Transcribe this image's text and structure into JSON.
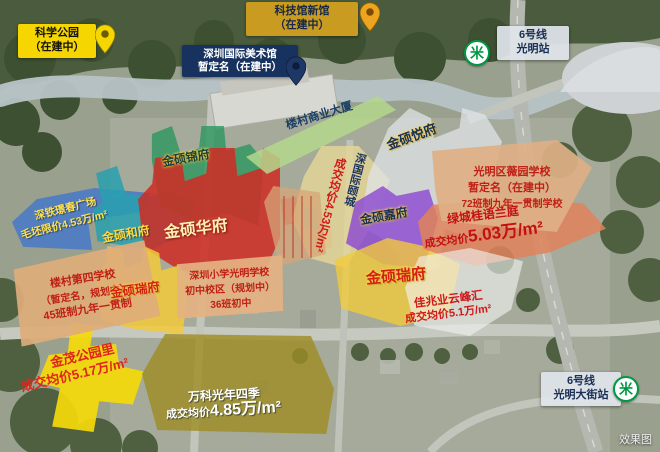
{
  "watermark": "效果图",
  "badges": {
    "science_park": {
      "line1": "科学公园",
      "line2": "（在建中）"
    },
    "tech_museum": {
      "line1": "科技馆新馆",
      "line2": "（在建中）"
    },
    "art_museum": {
      "line1": "深圳国际美术馆",
      "line2": "暂定名（在建中）"
    },
    "metro_guangming": {
      "line1": "6号线",
      "line2": "光明站"
    },
    "metro_guangming_street": {
      "line1": "6号线",
      "line2": "光明大街站"
    }
  },
  "parcels": {
    "hefu": {
      "label": "金硕和府"
    },
    "jinfu": {
      "label": "金硕锦府"
    },
    "huafu": {
      "label": "金硕华府"
    },
    "ruifu_west": {
      "label": "金硕瑞府"
    },
    "ruifu_east": {
      "label": "金硕瑞府"
    },
    "yuefu": {
      "label": "金硕悦府"
    },
    "jiafu": {
      "label": "金硕嘉府"
    },
    "commercial": {
      "label": "楼村商业大厦"
    }
  },
  "projects": {
    "shentie": {
      "name": "深铁璟春广场",
      "price": "毛坯限价4.53万/m²"
    },
    "shenguoji": {
      "name": "深国际颐城",
      "price": "成交均价4.53万/m²"
    },
    "lvcheng": {
      "name": "绿城桂语兰庭",
      "price_label": "成交均价",
      "price_value": "5.03万/m²"
    },
    "jiazhaoye": {
      "name": "佳兆业云峰汇",
      "price": "成交均价5.1万/m²"
    },
    "jinmao": {
      "name": "金茂公园里",
      "price": "成交均价5.17万/m²"
    },
    "vanke": {
      "name": "万科光年四季",
      "price_label": "成交均价",
      "price_value": "4.85万/m²"
    }
  },
  "schools": {
    "loucun4": {
      "line1": "楼村第四学校",
      "line2": "（暂定名，规划中）",
      "line3": "45班制九年一贯制"
    },
    "shenxiao": {
      "line1": "深圳小学光明学校",
      "line2": "初中校区（规划中）",
      "line3": "36班初中"
    },
    "weiyuan": {
      "line1": "光明区薇园学校",
      "line2": "暂定名（在建中）",
      "line3": "72班制九年一贯制学校"
    }
  },
  "icons": {
    "metro_logo": "米"
  },
  "colors": {
    "science_yellow": "#f5d600",
    "tech_gold": "#c99b20",
    "museum_navy": "#17325e",
    "metro_green": "#009943",
    "parcel_red": "#cd2d26",
    "parcel_yellow": "#f2ca3a",
    "parcel_purple": "#8a4bd2",
    "parcel_teal": "#28a0af",
    "parcel_blue": "#4678c8",
    "price_red": "#d01818"
  }
}
